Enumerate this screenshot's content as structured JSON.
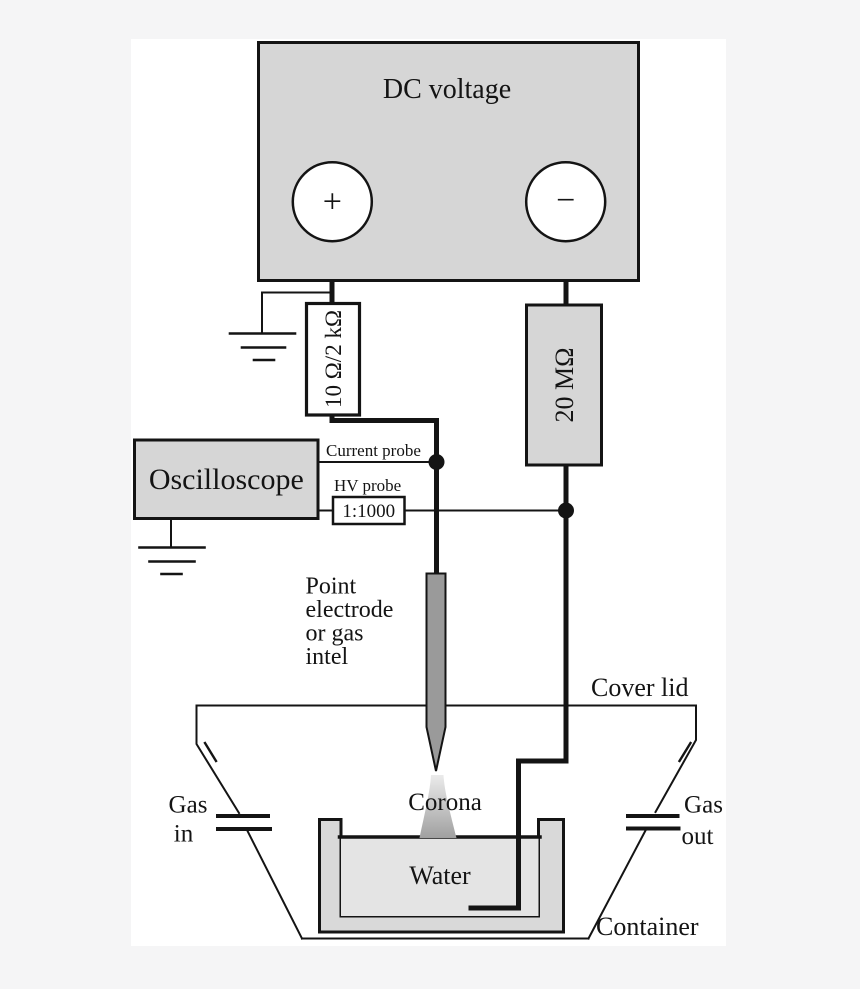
{
  "colors": {
    "background": "#f5f5f6",
    "panel": "#ffffff",
    "box_fill": "#d6d6d6",
    "resistor_shunt_fill": "#ffffff",
    "tub_fill": "#d9d9d9",
    "water_fill": "#e4e4e4",
    "electrode_fill": "#9a9a9a",
    "corona_top": "#ebebeb",
    "corona_bottom": "#a0a0a0",
    "line": "#141414"
  },
  "dc_supply": {
    "label": "DC voltage",
    "positive_terminal": "+",
    "negative_terminal": "−"
  },
  "resistors": {
    "shunt": "10 Ω/2 kΩ",
    "ballast": "20 MΩ"
  },
  "oscilloscope": {
    "label": "Oscilloscope"
  },
  "probes": {
    "current_label": "Current probe",
    "hv_label": "HV probe",
    "hv_ratio": "1:1000"
  },
  "electrode": {
    "line1": "Point",
    "line2": "electrode",
    "line3": "or gas",
    "line4": "intel"
  },
  "vessel": {
    "cover_lid": "Cover lid",
    "corona": "Corona",
    "water": "Water",
    "container": "Container",
    "gas_in_line1": "Gas",
    "gas_in_line2": "in",
    "gas_out_line1": "Gas",
    "gas_out_line2": "out"
  }
}
